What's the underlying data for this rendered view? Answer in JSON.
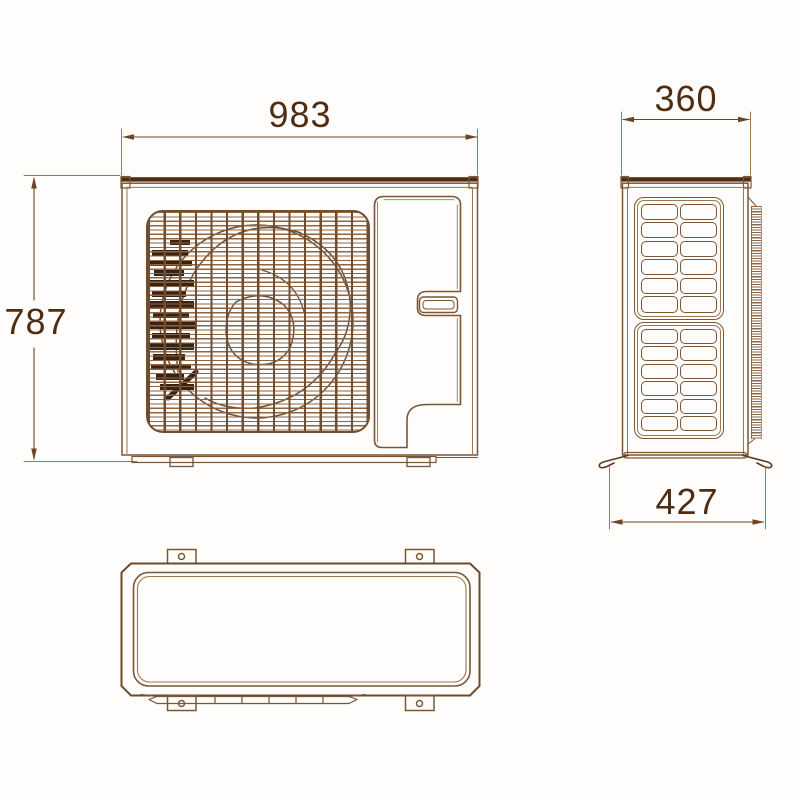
{
  "drawing": {
    "description": "air-conditioner-outdoor-unit-dimension-drawing",
    "dimensions": {
      "front_width": "983",
      "front_height": "787",
      "side_width": "360",
      "side_depth": "427"
    },
    "side_grille": {
      "panels": 2,
      "columns": 2,
      "rows": 6
    },
    "colors": {
      "line_medium": "#7a5637",
      "line_light": "#9b7850",
      "line_dark": "#4e2d13",
      "grille_horizontal": "#8d6745",
      "grille_vertical": "#6f4d31",
      "fan_dark_marks": "#3a2110",
      "background": "#fefdfb"
    }
  }
}
